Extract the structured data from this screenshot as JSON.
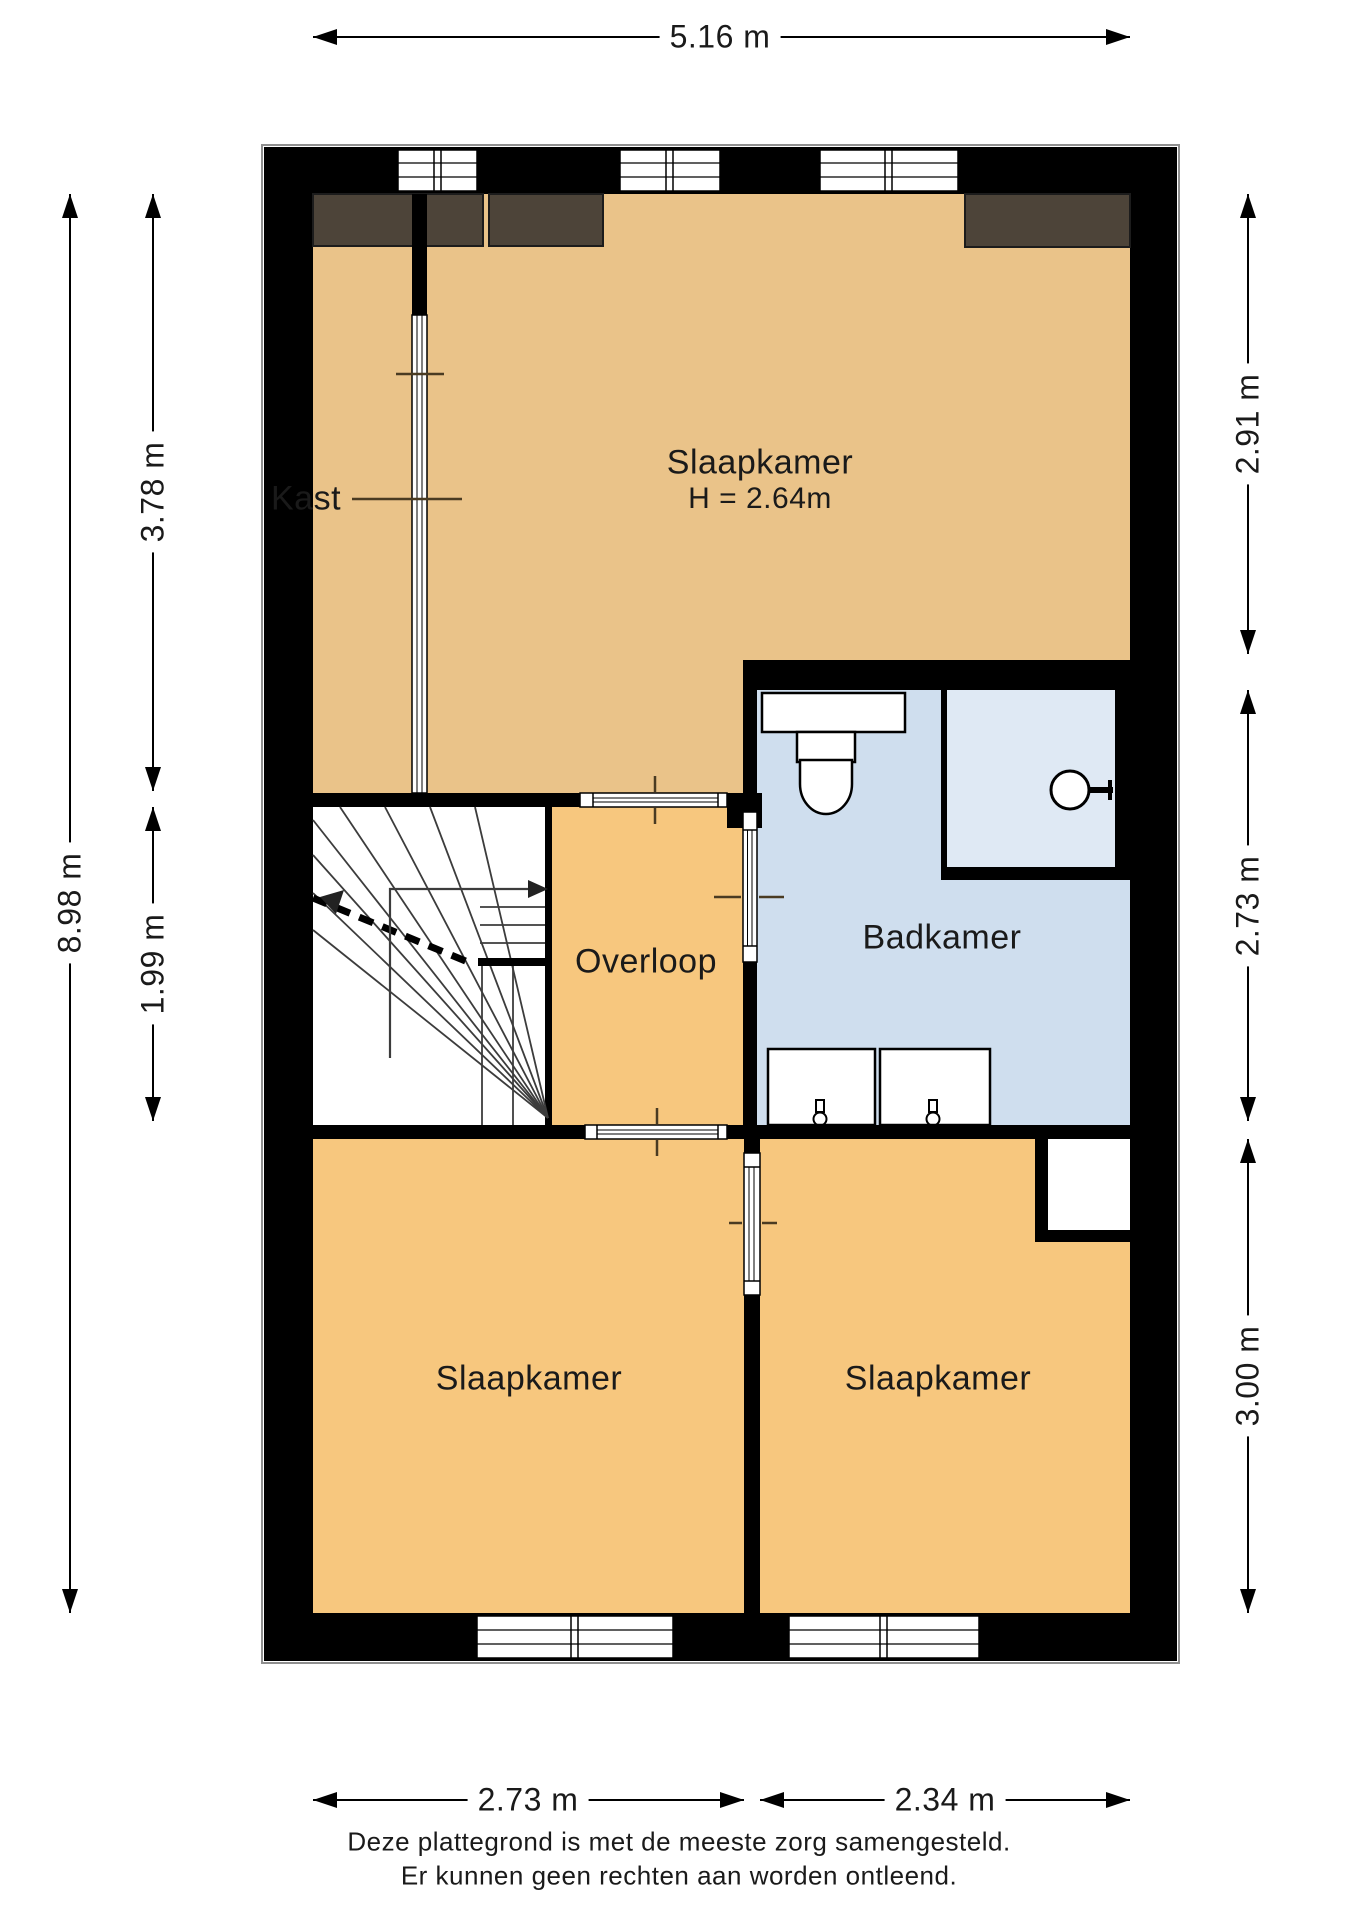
{
  "rooms": {
    "kast": "Kast",
    "bedroom_top": "Slaapkamer",
    "bedroom_top_height": "H = 2.64m",
    "landing": "Overloop",
    "bathroom": "Badkamer",
    "bedroom_bottom_left": "Slaapkamer",
    "bedroom_bottom_right": "Slaapkamer"
  },
  "dimensions": {
    "top_width": "5.16 m",
    "left_total": "8.98 m",
    "left_upper": "3.78 m",
    "left_lower": "1.99 m",
    "right_upper": "2.91 m",
    "right_middle": "2.73 m",
    "right_lower": "3.00 m",
    "bottom_left": "2.73 m",
    "bottom_right": "2.34 m"
  },
  "footer": {
    "line1": "Deze plattegrond is met de meeste zorg samengesteld.",
    "line2": "Er kunnen geen rechten aan worden ontleend."
  },
  "colors": {
    "wall": "#000000",
    "floor_tan": "#eac389",
    "floor_orange": "#f7c77e",
    "bathroom_blue": "#cfdeee",
    "shower_blue": "#dfe9f4",
    "storage_dark": "#4d4439",
    "stairs_bg": "#ffffff"
  }
}
